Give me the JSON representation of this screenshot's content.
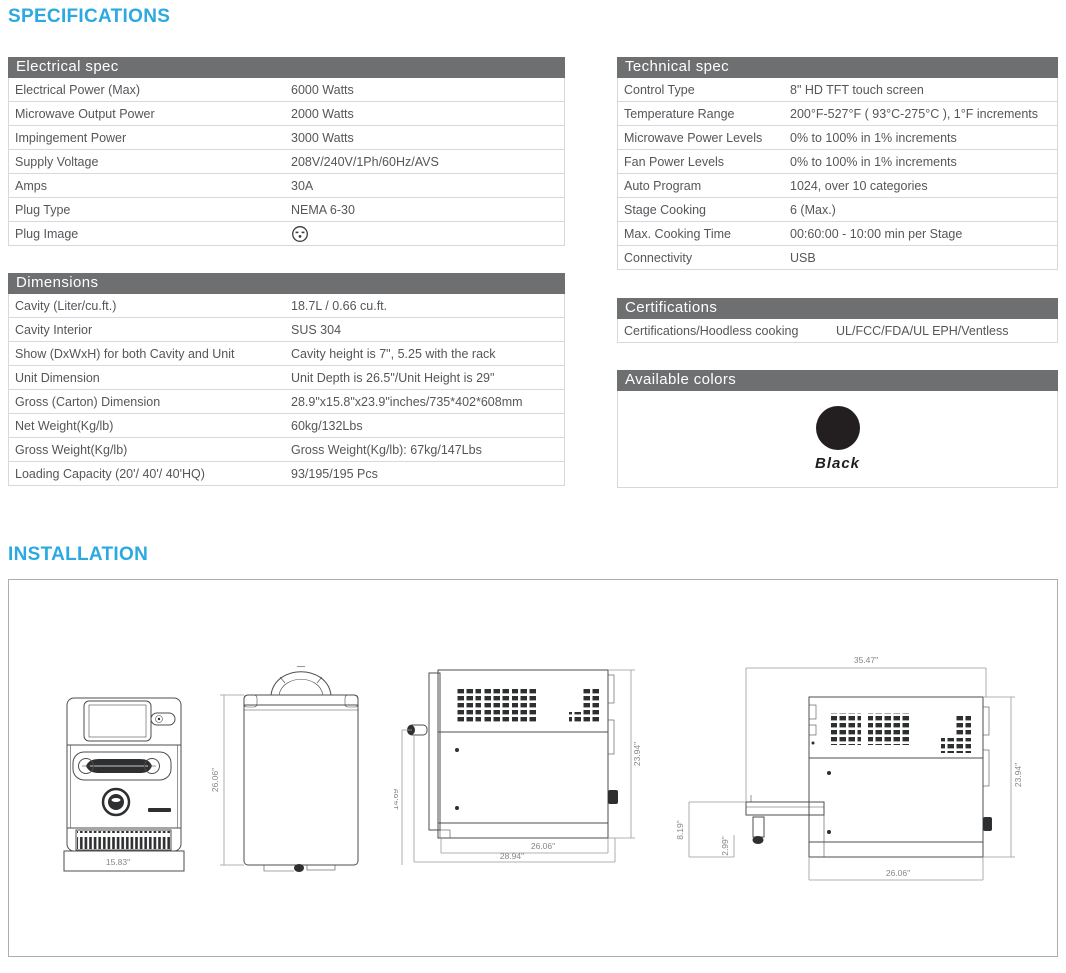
{
  "page": {
    "specifications_heading": "SPECIFICATIONS",
    "installation_heading": "INSTALLATION"
  },
  "colors": {
    "accent_blue": "#2BA9E0",
    "table_header_gray": "#6E6F71",
    "body_text_gray": "#55565A",
    "row_border_gray": "#D7D8DA"
  },
  "specs": {
    "electrical": {
      "title": "Electrical spec",
      "rows": [
        {
          "label": "Electrical Power (Max)",
          "value": "6000 Watts"
        },
        {
          "label": "Microwave Output Power",
          "value": "2000 Watts"
        },
        {
          "label": "Impingement Power",
          "value": "3000 Watts"
        },
        {
          "label": "Supply Voltage",
          "value": "208V/240V/1Ph/60Hz/AVS"
        },
        {
          "label": "Amps",
          "value": "30A"
        },
        {
          "label": "Plug Type",
          "value": "NEMA 6-30"
        },
        {
          "label": "Plug Image",
          "value": "",
          "icon": "nema-6-30-plug-icon"
        }
      ]
    },
    "dimensions": {
      "title": "Dimensions",
      "rows": [
        {
          "label": "Cavity (Liter/cu.ft.)",
          "value": "18.7L / 0.66 cu.ft."
        },
        {
          "label": "Cavity Interior",
          "value": "SUS 304"
        },
        {
          "label": "Show (DxWxH) for both Cavity and Unit",
          "value": "Cavity height is 7\", 5.25 with the rack"
        },
        {
          "label": "Unit Dimension",
          "value": "Unit Depth is 26.5\"/Unit Height is 29\""
        },
        {
          "label": "Gross (Carton) Dimension",
          "value": "28.9\"x15.8\"x23.9\"inches/735*402*608mm"
        },
        {
          "label": "Net Weight(Kg/lb)",
          "value": "60kg/132Lbs"
        },
        {
          "label": "Gross Weight(Kg/lb)",
          "value": "Gross Weight(Kg/lb): 67kg/147Lbs"
        },
        {
          "label": "Loading Capacity (20'/ 40'/ 40'HQ)",
          "value": "93/195/195 Pcs"
        }
      ]
    },
    "technical": {
      "title": "Technical spec",
      "rows": [
        {
          "label": "Control Type",
          "value": "8\" HD TFT touch screen"
        },
        {
          "label": "Temperature Range",
          "value": "200°F-527°F ( 93°C-275°C ), 1°F increments"
        },
        {
          "label": "Microwave Power Levels",
          "value": "0% to 100% in 1% increments"
        },
        {
          "label": "Fan Power Levels",
          "value": "0% to 100% in 1% increments"
        },
        {
          "label": "Auto Program",
          "value": "1024, over 10 categories"
        },
        {
          "label": "Stage Cooking",
          "value": "6 (Max.)"
        },
        {
          "label": "Max. Cooking Time",
          "value": "00:60:00 - 10:00 min per Stage"
        },
        {
          "label": "Connectivity",
          "value": "USB"
        }
      ]
    },
    "certifications": {
      "title": "Certifications",
      "rows": [
        {
          "label": "Certifications/Hoodless cooking",
          "value": "UL/FCC/FDA/UL EPH/Ventless"
        }
      ]
    },
    "available_colors": {
      "title": "Available colors",
      "swatches": [
        {
          "name": "Black",
          "hex": "#231F20"
        }
      ]
    }
  },
  "installation": {
    "front": {
      "width": "15.83\""
    },
    "top": {
      "depth": "26.06\""
    },
    "side": {
      "handle_height": "14.69\"",
      "height": "23.94\"",
      "depth": "26.06\"",
      "total_depth": "28.94\""
    },
    "side_open": {
      "total_depth": "35.47\"",
      "height": "23.94\"",
      "door_height": "8.19\"",
      "leg_height": "2.99\"",
      "depth": "26.06\""
    }
  }
}
